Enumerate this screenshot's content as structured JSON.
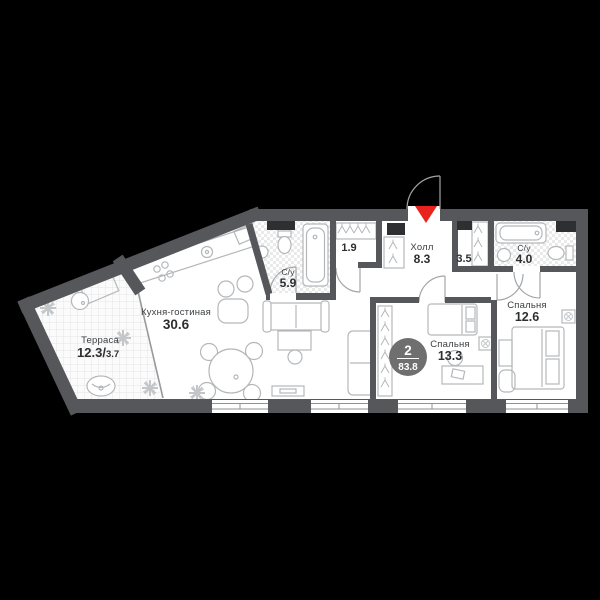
{
  "badge": {
    "rooms_count": "2",
    "total_area": "83.8"
  },
  "rooms": {
    "terrace": {
      "name": "Терраса",
      "area": "12.3",
      "sep": "/",
      "area_alt": "3.7"
    },
    "kitchen_living": {
      "name": "Кухня-гостиная",
      "area": "30.6"
    },
    "bathroom_small": {
      "name": "С/у",
      "area": "5.9"
    },
    "wardrobe_small": {
      "area": "1.9"
    },
    "hall": {
      "name": "Холл",
      "area": "8.3"
    },
    "wardrobe_large": {
      "area": "3.5"
    },
    "bathroom_master": {
      "name": "С/у",
      "area": "4.0"
    },
    "bedroom_master": {
      "name": "Спальня",
      "area": "12.6"
    },
    "bedroom_second": {
      "name": "Спальня",
      "area": "13.3"
    }
  },
  "colors": {
    "background": "#000000",
    "wall": "#55575a",
    "floor": "#ffffff",
    "entrance_red": "#e8231e",
    "badge_gray": "#6f6f6f"
  }
}
